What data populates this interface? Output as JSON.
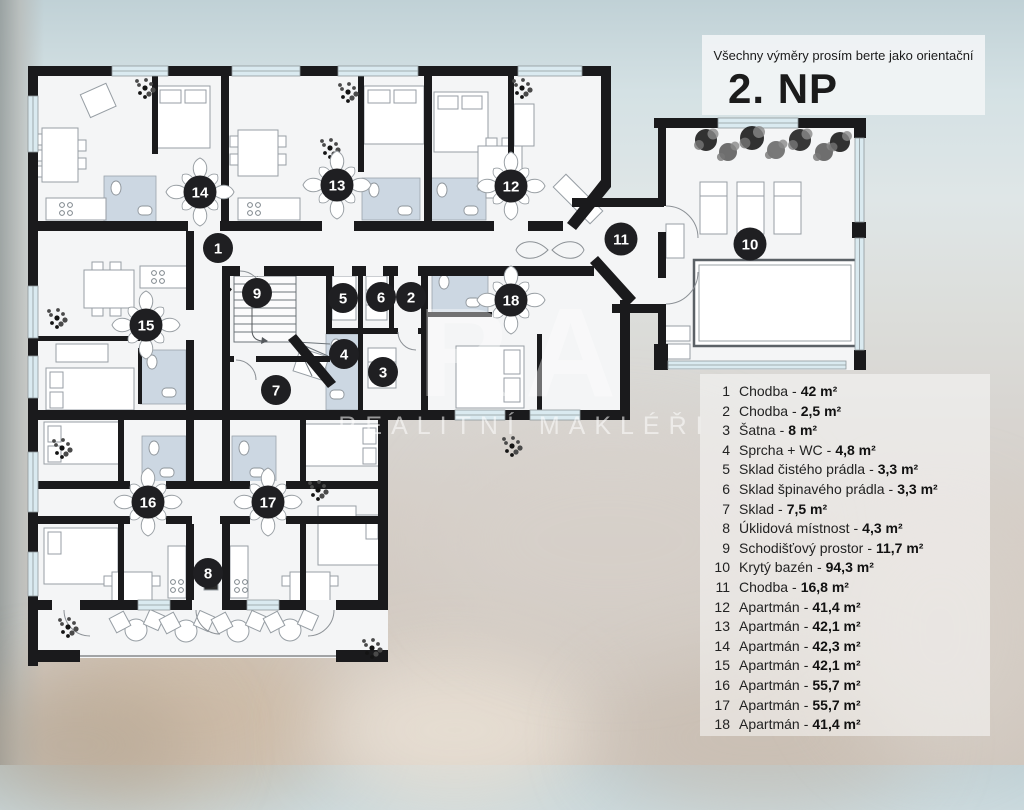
{
  "header": {
    "disclaimer": "Všechny výměry prosím berte jako orientační",
    "floor_title": "2. NP"
  },
  "watermark": {
    "logo_text": "RA",
    "subtitle": "REALITNÍ MAKLÉŘI"
  },
  "legend": {
    "separator": "-",
    "items": [
      {
        "num": "1",
        "label": "Chodba",
        "area": "42 m²"
      },
      {
        "num": "2",
        "label": "Chodba",
        "area": "2,5 m²"
      },
      {
        "num": "3",
        "label": "Šatna",
        "area": "8 m²"
      },
      {
        "num": "4",
        "label": "Sprcha + WC",
        "area": "4,8 m²"
      },
      {
        "num": "5",
        "label": "Sklad čistého prádla",
        "area": "3,3 m²"
      },
      {
        "num": "6",
        "label": "Sklad špinavého prádla",
        "area": "3,3 m²"
      },
      {
        "num": "7",
        "label": "Sklad",
        "area": "7,5 m²"
      },
      {
        "num": "8",
        "label": "Úklidová místnost",
        "area": "4,3 m²"
      },
      {
        "num": "9",
        "label": "Schodišťový prostor",
        "area": "11,7 m²"
      },
      {
        "num": "10",
        "label": "Krytý bazén",
        "area": "94,3 m²"
      },
      {
        "num": "11",
        "label": "Chodba",
        "area": "16,8 m²"
      },
      {
        "num": "12",
        "label": "Apartmán",
        "area": "41,4 m²"
      },
      {
        "num": "13",
        "label": "Apartmán",
        "area": "42,1 m²"
      },
      {
        "num": "14",
        "label": "Apartmán",
        "area": "42,3 m²"
      },
      {
        "num": "15",
        "label": "Apartmán",
        "area": "42,1 m²"
      },
      {
        "num": "16",
        "label": "Apartmán",
        "area": "55,7 m²"
      },
      {
        "num": "17",
        "label": "Apartmán",
        "area": "55,7 m²"
      },
      {
        "num": "18",
        "label": "Apartmán",
        "area": "41,4 m²"
      }
    ]
  },
  "plan": {
    "room_markers": [
      {
        "num": "1",
        "x": 218,
        "y": 248,
        "star": false
      },
      {
        "num": "2",
        "x": 411,
        "y": 297,
        "star": false
      },
      {
        "num": "3",
        "x": 383,
        "y": 372,
        "star": false
      },
      {
        "num": "4",
        "x": 344,
        "y": 354,
        "star": false
      },
      {
        "num": "5",
        "x": 343,
        "y": 298,
        "star": false
      },
      {
        "num": "6",
        "x": 381,
        "y": 297,
        "star": false
      },
      {
        "num": "7",
        "x": 276,
        "y": 390,
        "star": false
      },
      {
        "num": "8",
        "x": 208,
        "y": 573,
        "star": false
      },
      {
        "num": "9",
        "x": 257,
        "y": 293,
        "star": false
      },
      {
        "num": "10",
        "x": 750,
        "y": 244,
        "star": false
      },
      {
        "num": "11",
        "x": 621,
        "y": 239,
        "star": false
      },
      {
        "num": "12",
        "x": 511,
        "y": 186,
        "star": true
      },
      {
        "num": "13",
        "x": 337,
        "y": 185,
        "star": true
      },
      {
        "num": "14",
        "x": 200,
        "y": 192,
        "star": true
      },
      {
        "num": "15",
        "x": 146,
        "y": 325,
        "star": true
      },
      {
        "num": "16",
        "x": 148,
        "y": 502,
        "star": true
      },
      {
        "num": "17",
        "x": 268,
        "y": 502,
        "star": true
      },
      {
        "num": "18",
        "x": 511,
        "y": 300,
        "star": true
      }
    ]
  },
  "colors": {
    "wall": "#1a1a1c",
    "floor": "#f4f5f6",
    "bath": "#ccd7e2",
    "window": "#daeaf0",
    "marker": "#1f1f22"
  }
}
